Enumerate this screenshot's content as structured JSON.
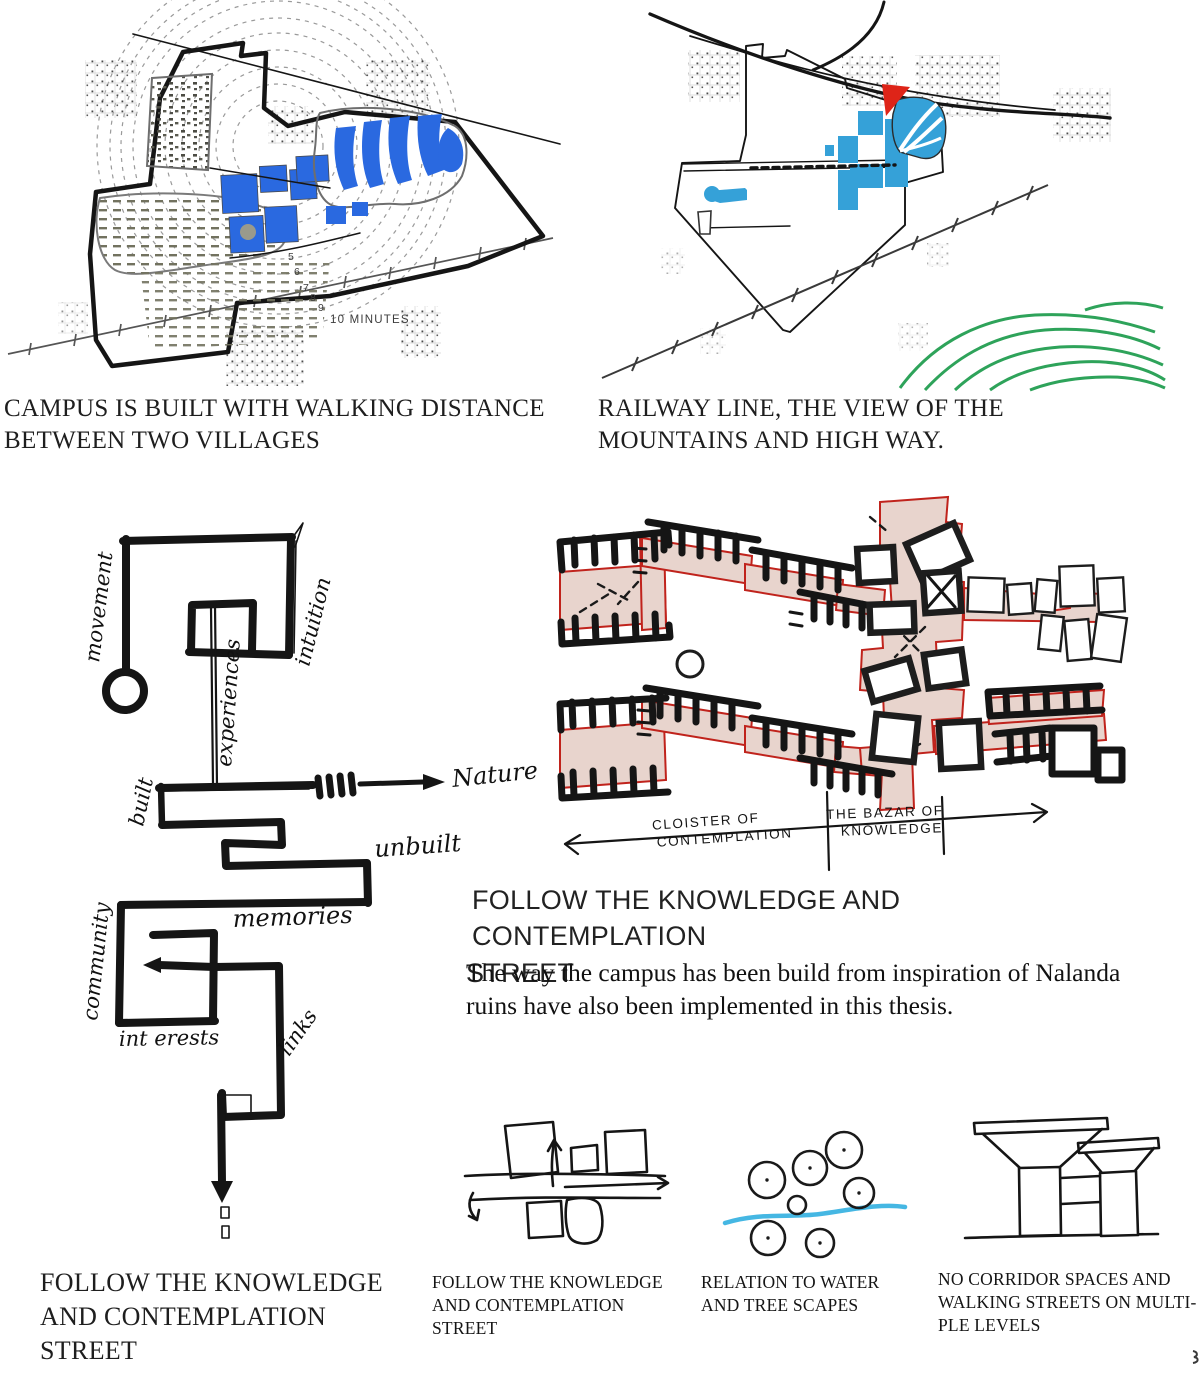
{
  "colors": {
    "water_dark": "#2a69e0",
    "water_light": "#35a1d8",
    "accent_red": "#de2418",
    "street_pink": "#e8d4cd",
    "street_red": "#c0231c",
    "contour_green": "#2ea35a",
    "road_yellow": "#e2ce20",
    "road_orange": "#dd8a1c"
  },
  "maps": {
    "campus": {
      "caption_lines": [
        "CAMPUS IS BUILT WITH WALKING DISTANCE",
        "BETWEEN TWO VILLAGES"
      ],
      "ten_minutes_label": "10 MINUTES",
      "ring_numbers": [
        "5",
        "6",
        "7",
        "8",
        "9"
      ]
    },
    "context": {
      "caption_lines": [
        "RAILWAY LINE, THE VIEW OF THE",
        "MOUNTAINS AND HIGH WAY."
      ]
    }
  },
  "street_diagram": {
    "labels": {
      "movement": "movement",
      "intuition": "intuition",
      "experiences": "experiences",
      "built": "built",
      "nature": "Nature",
      "unbuilt": "unbuilt",
      "memories": "memories",
      "community": "community",
      "interests": "int erests",
      "links": "links"
    },
    "caption_lines": [
      "FOLLOW THE KNOWLEDGE",
      "AND CONTEMPLATION",
      "STREET"
    ]
  },
  "plan": {
    "axis": {
      "cloister_line1": "CLOISTER OF",
      "cloister_line2": "CONTEMPLATION",
      "bazar_line1": "THE BAZAR OF",
      "bazar_line2": "KNOWLEDGE"
    },
    "heading_lines": [
      "FOLLOW THE KNOWLEDGE AND CONTEMPLATION",
      "STREET"
    ],
    "body_lines": [
      "The way the campus has been build from inspiration of Nalanda",
      "ruins have also been implemented in this thesis."
    ]
  },
  "bottom_row": {
    "street_caption_lines": [
      "FOLLOW THE KNOWLEDGE",
      "AND CONTEMPLATION",
      "STREET"
    ],
    "water_caption_lines": [
      "RELATION TO WATER",
      "AND TREE SCAPES"
    ],
    "corridor_caption_lines": [
      "NO CORRIDOR SPACES AND",
      "WALKING STREETS ON MULTI-",
      "PLE LEVELS"
    ]
  }
}
